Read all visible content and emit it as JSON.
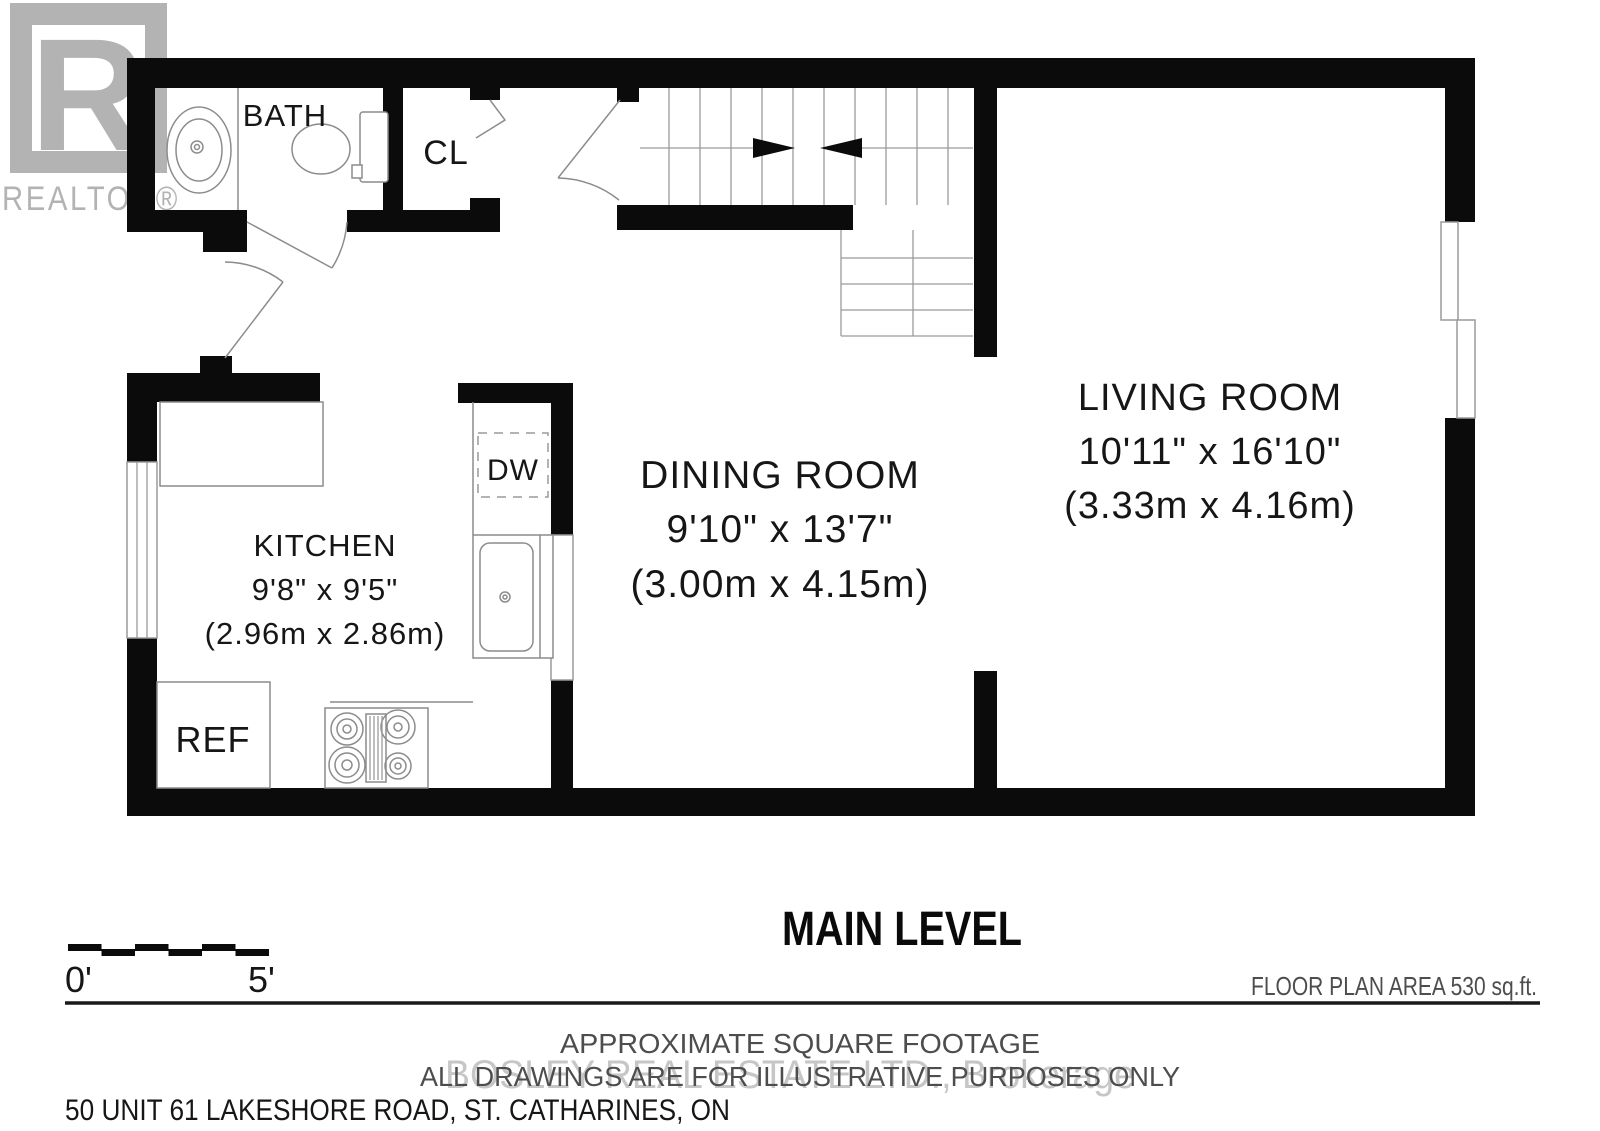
{
  "branding": {
    "realtor_letter": "R",
    "realtor_word": "REALTOR®"
  },
  "rooms": {
    "bath": {
      "label": "BATH"
    },
    "closet": {
      "label": "CL"
    },
    "kitchen": {
      "name": "KITCHEN",
      "dims_imperial": "9'8\" x 9'5\"",
      "dims_metric": "(2.96m x 2.86m)"
    },
    "dining": {
      "name": "DINING ROOM",
      "dims_imperial": "9'10\" x 13'7\"",
      "dims_metric": "(3.00m x 4.15m)"
    },
    "living": {
      "name": "LIVING ROOM",
      "dims_imperial": "10'11\" x 16'10\"",
      "dims_metric": "(3.33m x 4.16m)"
    }
  },
  "appliances": {
    "dishwasher": "DW",
    "refrigerator": "REF"
  },
  "footer": {
    "level_title": "MAIN LEVEL",
    "area_note": "FLOOR PLAN AREA 530 sq.ft.",
    "approx_line1": "APPROXIMATE SQUARE FOOTAGE",
    "approx_line2": "ALL DRAWINGS ARE FOR ILLUSTRATIVE PURPOSES ONLY",
    "watermark": "BOSLEY REAL ESTATE LTD., Brokerage",
    "address": "50 UNIT 61 LAKESHORE ROAD, ST. CATHARINES, ON",
    "scale_zero": "0'",
    "scale_five": "5'"
  },
  "colors": {
    "wall": "#0b0b0b",
    "fixture_line": "#8c8c8c",
    "logo_gray": "#b3b3b3",
    "watermark_gray": "#c6c6c6",
    "text": "#161616"
  }
}
